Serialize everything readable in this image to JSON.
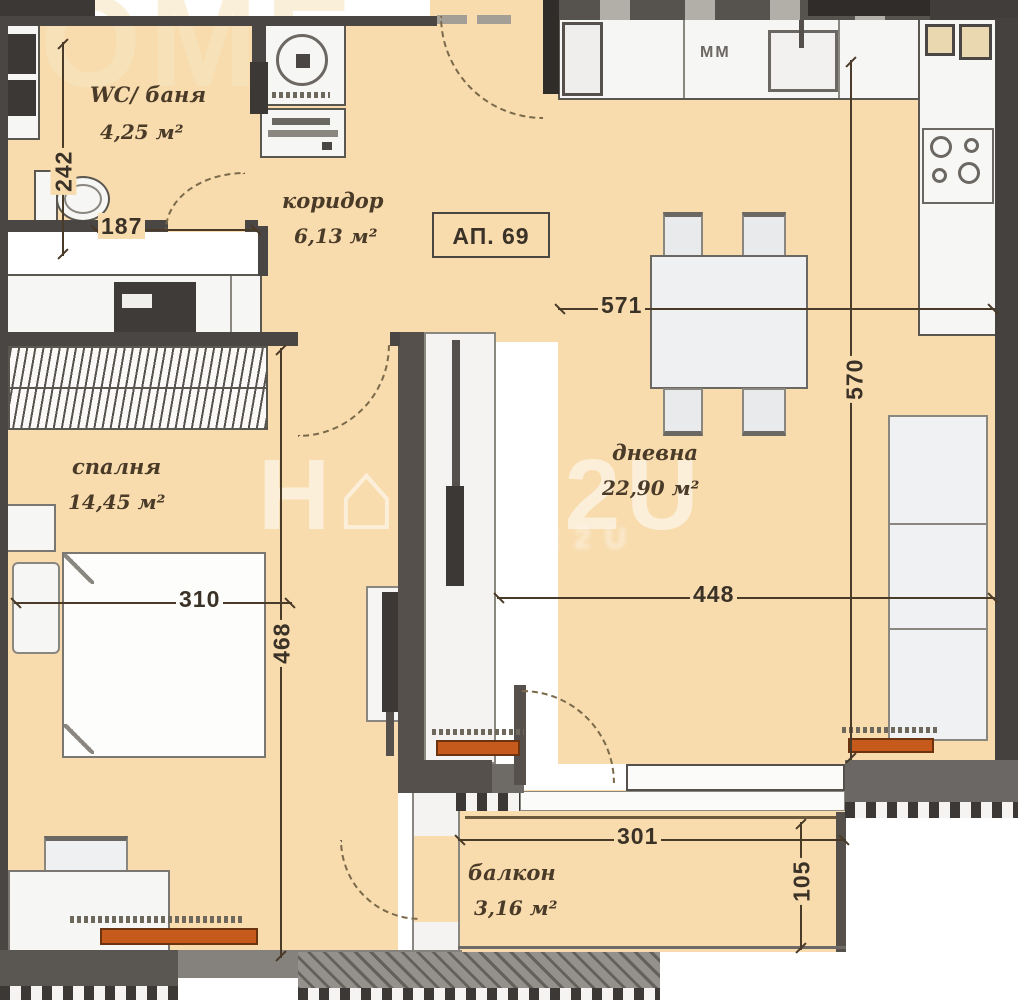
{
  "plan": {
    "apartment_badge": "АП. 69",
    "kitchen_unit_label": "MM",
    "watermark": {
      "main": "H⌂ME2U",
      "secondary": "HOME2U",
      "fragment": "OME"
    },
    "rooms": [
      {
        "name": "WC/ баня",
        "area": "4,25 м²"
      },
      {
        "name": "коридор",
        "area": "6,13 м²"
      },
      {
        "name": "дневна",
        "area": "22,90 м²"
      },
      {
        "name": "спалня",
        "area": "14,45 м²"
      },
      {
        "name": "балкон",
        "area": "3,16 м²"
      }
    ],
    "dims": {
      "d187": "187",
      "d242": "242",
      "d571": "571",
      "d570": "570",
      "d448": "448",
      "d310": "310",
      "d468": "468",
      "d301": "301",
      "d105": "105"
    },
    "colors": {
      "floor": "#f8dcae",
      "wall": "#4a4644",
      "radiator": "#c65a1d"
    }
  }
}
